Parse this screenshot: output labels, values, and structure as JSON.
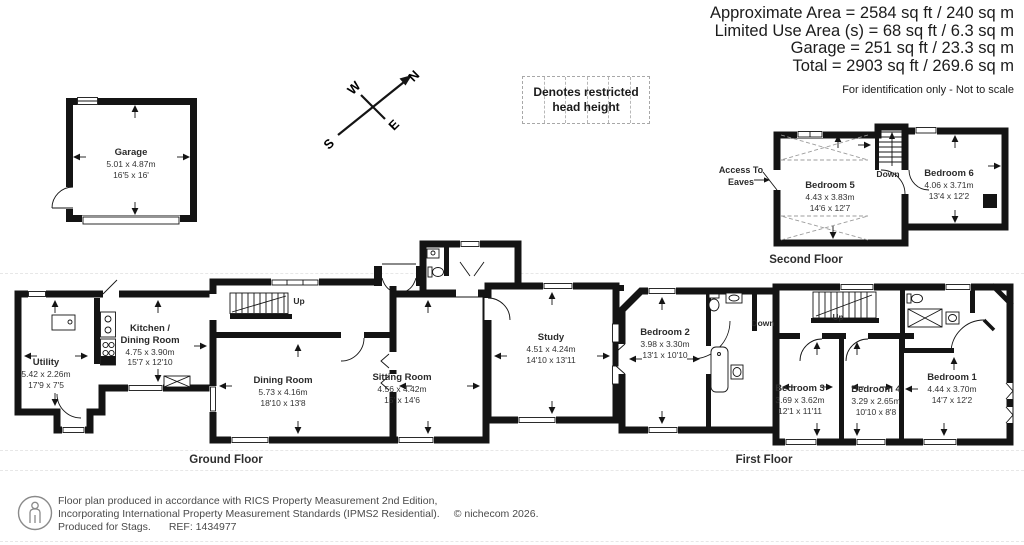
{
  "header": {
    "area_lines": [
      "Approximate Area = 2584 sq ft / 240 sq m",
      "Limited Use Area (s) = 68 sq ft / 6.3 sq m",
      "Garage = 251 sq ft / 23.3 sq m",
      "Total = 2903 sq ft / 269.6 sq m"
    ],
    "note": "For identification only - Not to scale"
  },
  "legend": {
    "restricted": "Denotes restricted head height"
  },
  "compass": {
    "north": "N",
    "south": "S",
    "east": "E",
    "west": "W"
  },
  "floors": {
    "garage": {
      "rooms": [
        {
          "name": "Garage",
          "metric": "5.01 x 4.87m",
          "imperial": "16'5 x 16'"
        }
      ]
    },
    "second": {
      "caption": "Second Floor",
      "access_label": "Access To Eaves",
      "stairs_label": "Down",
      "rooms": [
        {
          "name": "Bedroom 5",
          "metric": "4.43 x 3.83m",
          "imperial": "14'6 x 12'7"
        },
        {
          "name": "Bedroom 6",
          "metric": "4.06 x 3.71m",
          "imperial": "13'4 x 12'2"
        }
      ]
    },
    "ground": {
      "caption": "Ground Floor",
      "stairs_label": "Up",
      "rooms": [
        {
          "name": "Utility",
          "metric": "5.42 x 2.26m",
          "imperial": "17'9 x 7'5"
        },
        {
          "name": "Kitchen / Dining Room",
          "metric": "4.75 x 3.90m",
          "imperial": "15'7 x 12'10"
        },
        {
          "name": "Dining Room",
          "metric": "5.73 x 4.16m",
          "imperial": "18'10 x 13'8"
        },
        {
          "name": "Sitting Room",
          "metric": "4.56 x 4.42m",
          "imperial": "15' x 14'6"
        },
        {
          "name": "Study",
          "metric": "4.51 x 4.24m",
          "imperial": "14'10 x 13'11"
        }
      ]
    },
    "first": {
      "caption": "First Floor",
      "stairs_down_label": "Down",
      "stairs_up_label": "Up",
      "rooms": [
        {
          "name": "Bedroom 2",
          "metric": "3.98 x 3.30m",
          "imperial": "13'1 x 10'10"
        },
        {
          "name": "Bedroom 3",
          "metric": "3.69 x 3.62m",
          "imperial": "12'1 x 11'11"
        },
        {
          "name": "Bedroom 4",
          "metric": "3.29 x 2.65m",
          "imperial": "10'10 x 8'8"
        },
        {
          "name": "Bedroom 1",
          "metric": "4.44 x 3.70m",
          "imperial": "14'7 x 12'2"
        }
      ]
    }
  },
  "footer": {
    "line1": "Floor plan produced in accordance with RICS Property Measurement 2nd Edition,",
    "line2": "Incorporating International Property Measurement Standards (IPMS2 Residential).",
    "copyright": "© nichecom 2026.",
    "produced_for": "Produced for Stags.",
    "ref": "REF: 1434977"
  },
  "colors": {
    "wall": "#141414",
    "label_text": "#333333",
    "restricted_dash": "#9c9c9c",
    "footer_text": "#4a4a4a"
  }
}
